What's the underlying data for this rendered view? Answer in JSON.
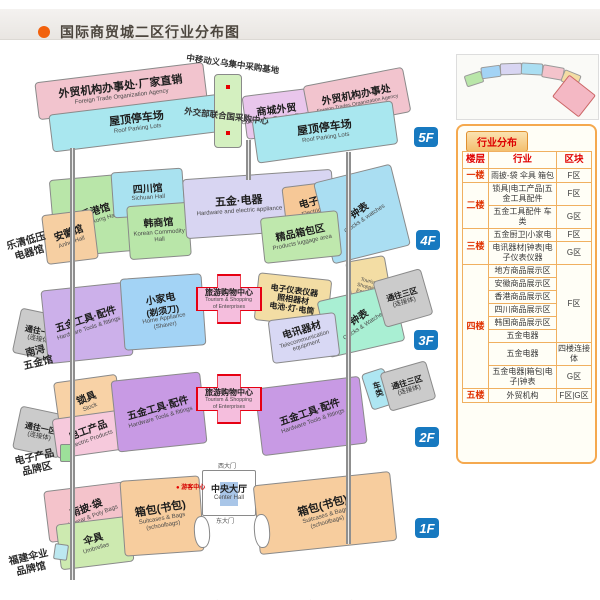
{
  "colors": {
    "badge_blue": "#1779c0",
    "legend_orange": "#f5a94f",
    "cross_red": "#e60012",
    "title_dot": "#f2610c"
  },
  "header": {
    "title": "国际商贸城二区行业分布图"
  },
  "caption": {
    "zh": "国际商贸城二区行业布局及交通图",
    "en": "The Major Industry layout and transport map of International Trade Mart District Two"
  },
  "floors": {
    "f5": {
      "badge": "5F",
      "ftoa_left": {
        "zh": "外贸机构办事处·厂家直销",
        "en": "Foreign Trade Organization Agency"
      },
      "roof_left": {
        "zh": "屋顶停车场",
        "en": "Roof Parking Lots"
      },
      "mobile_base": "中移动义乌集中采购基地",
      "un_center": "外交部联合国采购中心",
      "commodity": {
        "zh": "商城外贸",
        "en": "Commodity Foreign Trades"
      },
      "ftoa_right": {
        "zh": "外贸机构办事处",
        "en": "Foreign Trades Organization Agency"
      },
      "roof_right": {
        "zh": "屋顶停车场",
        "en": "Roof Parking Lots"
      }
    },
    "f4": {
      "badge": "4F",
      "hongkong": {
        "zh": "香港馆",
        "en": "Hongkong Hall"
      },
      "sichuan": {
        "zh": "四川馆",
        "en": "Sichuan Hall"
      },
      "anhui": {
        "zh": "安徽馆",
        "en": "Anhui Hall"
      },
      "korean": {
        "zh": "韩商馆",
        "en": "Korean Commodity Hall"
      },
      "hardware": {
        "zh": "五金·电器",
        "en": "Hardware and electric appliance"
      },
      "electric": {
        "zh": "电子",
        "en": "Electric"
      },
      "clocks": {
        "zh": "钟表",
        "en": "Clocks & watches"
      },
      "luggage": {
        "zh": "精品箱包区",
        "en": "Products luggage area"
      },
      "side_label": {
        "line1": "乐清低压",
        "line2": "电器馆"
      }
    },
    "f3": {
      "badge": "3F",
      "conn_left": {
        "zh": "通往一区",
        "sub": "(连接体)"
      },
      "hardware": {
        "zh": "五金工具·配件",
        "en": "Hardware Tools & fittings"
      },
      "appliance": {
        "zh": "小家电",
        "zh2": "(剃须刀)",
        "en": "Home Appliance",
        "en2": "(Shaver)"
      },
      "tourism": {
        "zh": "旅游购物中心",
        "en1": "Tourism & Shopping",
        "en2": "of Enterprises"
      },
      "instruments": {
        "line1": "电子仪表仪器",
        "line2": "照相器材",
        "line3": "电池·灯·电筒"
      },
      "tower_en": "Tourism & Shopping of Enterprises",
      "clocks": {
        "zh": "钟表",
        "en": "Clocks & Watches"
      },
      "telecom": {
        "zh": "电讯器材",
        "en": "Telecommunication equipment"
      },
      "conn_right": {
        "zh": "通往三区",
        "sub": "(连接体)"
      },
      "side_label": {
        "line1": "南浔",
        "line2": "五金馆"
      }
    },
    "f2": {
      "badge": "2F",
      "conn_left": {
        "zh": "通往一区",
        "sub": "(连接体)"
      },
      "lock": {
        "zh": "锁具",
        "en": "Stock"
      },
      "electric_products": {
        "zh": "电工产品",
        "en": "Electric Products"
      },
      "hardware_left": {
        "zh": "五金工具·配件",
        "en": "Hardware Tools & fittings"
      },
      "tourism": {
        "zh": "旅游购物中心",
        "en1": "Tourism & Shopping",
        "en2": "of Enterprises"
      },
      "hardware_right": {
        "zh": "五金工具·配件",
        "en": "Hardware Tools & fittings"
      },
      "vehicles": "车类",
      "conn_right": {
        "zh": "通往三区",
        "sub": "(连接体)"
      },
      "side_label": {
        "line1": "电子产品",
        "line2": "品牌区"
      }
    },
    "f1": {
      "badge": "1F",
      "rainwear": {
        "zh": "雨披·袋",
        "en": "Rainwear & Poly Bags"
      },
      "umbrella": {
        "zh": "伞具",
        "en": "Umbrellas"
      },
      "bags_left": {
        "zh": "箱包(书包)",
        "en1": "Suitcases & Bags",
        "en2": "(schoolbags)"
      },
      "visitor_center": "游客中心",
      "hall": {
        "zh": "中央大厅",
        "en": "Center Hall"
      },
      "west_gate": "西大门",
      "east_gate": "东大门",
      "bags_right": {
        "zh": "箱包(书包)",
        "en1": "Suitcases & Bags",
        "en2": "(schoolbags)"
      },
      "side_label": {
        "line1": "福建伞业",
        "line2": "品牌馆"
      }
    }
  },
  "legend": {
    "title": "行业分布",
    "headers": {
      "floor": "楼层",
      "industry": "行业",
      "block": "区块"
    },
    "rows": [
      {
        "floor": "一楼",
        "industry": "雨披-袋 伞具 箱包",
        "block": "F区"
      },
      {
        "floor": "二楼",
        "industry": "锁具|电工产品|五金工具配件",
        "block": "F区"
      },
      {
        "industry": "五金工具配件 车类",
        "block": "G区"
      },
      {
        "floor": "三楼",
        "industry": "五金厨卫|小家电",
        "block": "F区"
      },
      {
        "industry": "电讯器材|钟表|电子仪表仪器",
        "block": "G区"
      },
      {
        "floor": "四楼",
        "industry": "地方商品展示区",
        "block": "F区"
      },
      {
        "industry": "安徽商品展示区"
      },
      {
        "industry": "香港商品展示区"
      },
      {
        "industry": "四川商品展示区"
      },
      {
        "industry": "韩国商品展示区"
      },
      {
        "industry": "五金电器"
      },
      {
        "industry": "五金电器",
        "block": "四楼连接体"
      },
      {
        "industry": "五金电器|箱包|电子|钟表",
        "block": "G区"
      },
      {
        "floor": "五楼",
        "industry": "外贸机构",
        "block": "F区|G区"
      }
    ]
  }
}
